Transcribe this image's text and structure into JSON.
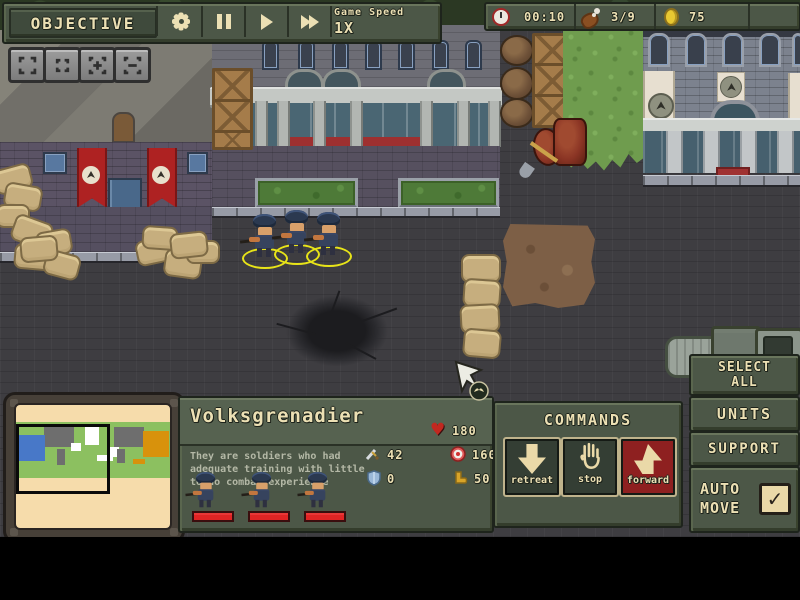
{
  "colors": {
    "panel_olive": "#4c5747",
    "text_cream": "#ece0b4",
    "forward_red": "#8e2020",
    "banner_red": "#ae2222",
    "minimap_paper": "#f6dcab",
    "selection_yellow": "#e8e418",
    "hp_red": "#e02424",
    "gold_coin": "#e8c832"
  },
  "icons": {
    "heart": "♥",
    "check": "✓"
  },
  "top_bar": {
    "objective": "OBJECTIVE",
    "game_speed_label": "Game Speed",
    "game_speed_value": "1X"
  },
  "resources": {
    "time": "00:10",
    "food": "3/9",
    "gold": "75"
  },
  "unit_panel": {
    "title": "Volksgrenadier",
    "description": "They are soldiers who had adequate training with little to no combat experience",
    "stats": {
      "health": "180",
      "attack": "42",
      "range": "160",
      "armor": "0",
      "speed": "50"
    }
  },
  "commands": {
    "title": "COMMANDS",
    "retreat": "retreat",
    "stop": "stop",
    "forward": "forward"
  },
  "side_panel": {
    "select_all": "SELECT ALL",
    "units": "UNITS",
    "support": "SUPPORT",
    "auto_move": "AUTO MOVE",
    "auto_move_checked": true
  }
}
